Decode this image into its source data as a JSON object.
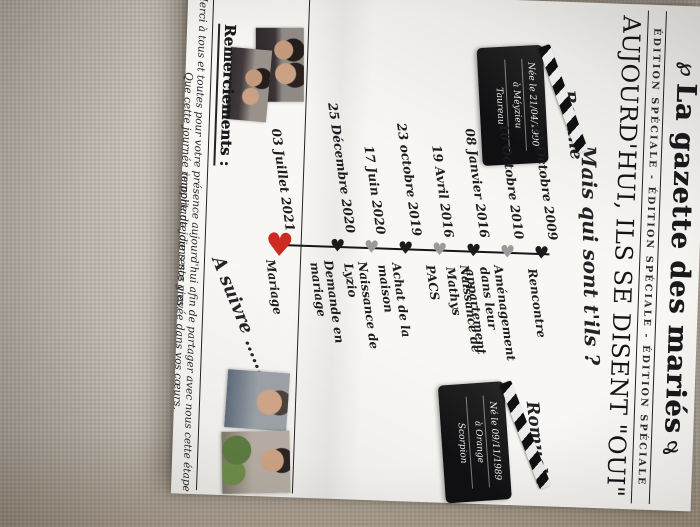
{
  "masthead": {
    "flourish_left": "℘",
    "flourish_right": "℘",
    "title": "La gazette des mariés",
    "edition_strip": "ÉDITION SPÉCIALE - ÉDITION SPÉCIALE - ÉDITION SPÉCIALE"
  },
  "headline": "AUJOURD'HUI, ILS SE DISENT \"OUI\"",
  "subtitle": "Mais qui sont t'ils ?",
  "partners": {
    "left": {
      "name": "Roxane",
      "clapper_lines": [
        "Née le 21/04/1990",
        "à Méyzieu",
        "Taureau"
      ]
    },
    "right": {
      "name": "Romuald",
      "clapper_lines": [
        "Né le 09/11/1989",
        "à Orange",
        "Scorpion"
      ]
    }
  },
  "timeline": {
    "entries": [
      {
        "date": "01 Octobre 2009",
        "event": "Rencontre",
        "heart": "black"
      },
      {
        "date": "10 Octobre 2010",
        "event": "Aménagement dans leur appartement",
        "heart": "gray"
      },
      {
        "date": "08 Janvier 2016",
        "event": "Naissance de Mathys",
        "heart": "black"
      },
      {
        "date": "19 Avril 2016",
        "event": "PACS",
        "heart": "gray"
      },
      {
        "date": "23 octobre 2019",
        "event": "Achat de la maison",
        "heart": "black"
      },
      {
        "date": "17 Juin 2020",
        "event": "Naissance de Lyzio",
        "heart": "gray"
      },
      {
        "date": "25 Décembre 2020",
        "event": "Demande en mariage",
        "heart": "black"
      },
      {
        "date": "03 Juillet 2021",
        "event": "Mariage",
        "heart": "red"
      }
    ],
    "heart_glyph": "♥",
    "to_be_continued": "A suivre ......"
  },
  "thanks": {
    "heading": "Remerciements :",
    "line1": "Merci à tous et toutes pour votre présence aujourd'hui afin de partager avec nous cette étape importante dans nos vies.",
    "line2": "Que cette journée remplie de joie reste gravée dans vos cœurs."
  },
  "colors": {
    "heart_black": "#1a1a1c",
    "heart_gray": "#9a9a9a",
    "heart_red": "#cd2a20"
  }
}
